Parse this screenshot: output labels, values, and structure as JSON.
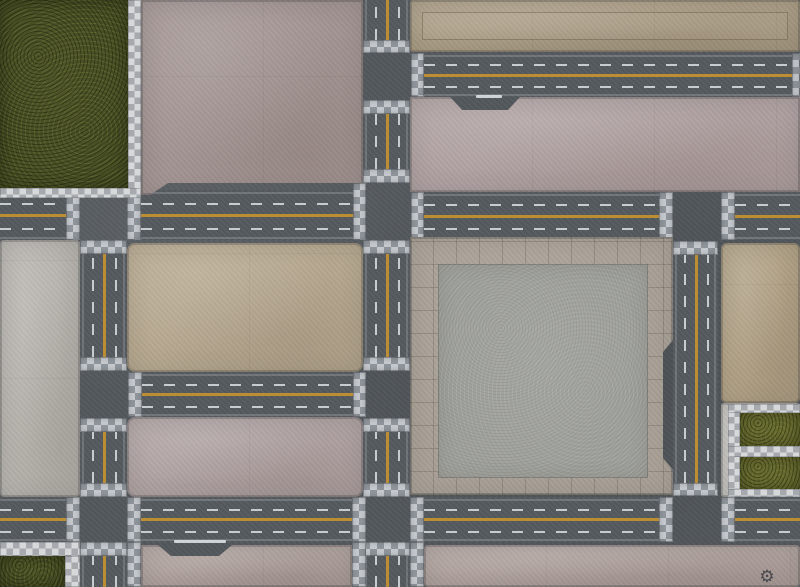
{
  "scene": {
    "description": "Top-down city-streets gaming mat: asphalt roads with yellow center lines and dashed lanes, checkered crosswalks, concrete city blocks, central tiled plaza, grass corner lots",
    "canvas": {
      "width": 800,
      "height": 587
    }
  },
  "palette": {
    "asphalt": "#53585d",
    "lane_yellow": "#bb8e33",
    "lane_white": "#d8dde1",
    "crosswalk_light": "#c5c9cd",
    "crosswalk_dark": "#8f959b",
    "sidewalk_light": "#d6d8da",
    "sidewalk_dark": "#a6aaae",
    "grass_dark": "#474d24",
    "grass_olive": "#696b2f",
    "concrete_mauve": "#a29492",
    "concrete_tan": "#ab9d85",
    "concrete_pink": "#b0a1a1",
    "concrete_gray": "#b7b4ae",
    "concrete_warm_tan": "#b7a88f",
    "plaza_tile": "#a8a096",
    "plaza_inner": "#9da09b",
    "bottom_pink": "#b0a29e",
    "frame_light": "#c4c2bd"
  },
  "icons": {
    "gear_logo": "⚙"
  },
  "regions": [
    {
      "name": "asphalt-base",
      "type": "base",
      "x": 0,
      "y": 0,
      "w": 800,
      "h": 587
    },
    {
      "name": "road-west-horizontal-seg-1",
      "type": "road-h",
      "x": 0,
      "y": 190,
      "w": 66,
      "h": 50
    },
    {
      "name": "road-west-horizontal-seg-2",
      "type": "road-h",
      "x": 141,
      "y": 190,
      "w": 212,
      "h": 50
    },
    {
      "name": "road-east-horizontal-seg-1",
      "type": "road-h",
      "x": 424,
      "y": 192,
      "w": 235,
      "h": 48
    },
    {
      "name": "road-east-horizontal-seg-2",
      "type": "road-h",
      "x": 735,
      "y": 192,
      "w": 65,
      "h": 48
    },
    {
      "name": "road-top-right-horizontal",
      "type": "road-h",
      "x": 424,
      "y": 53,
      "w": 368,
      "h": 44
    },
    {
      "name": "road-mid-horizontal",
      "type": "road-h",
      "x": 142,
      "y": 372,
      "w": 211,
      "h": 45
    },
    {
      "name": "road-bottom-horizontal-seg-1",
      "type": "road-h",
      "x": 0,
      "y": 497,
      "w": 66,
      "h": 45
    },
    {
      "name": "road-bottom-horizontal-seg-2",
      "type": "road-h",
      "x": 141,
      "y": 497,
      "w": 211,
      "h": 45
    },
    {
      "name": "road-bottom-horizontal-seg-3",
      "type": "road-h",
      "x": 424,
      "y": 497,
      "w": 235,
      "h": 45
    },
    {
      "name": "road-bottom-horizontal-seg-4",
      "type": "road-h",
      "x": 735,
      "y": 497,
      "w": 65,
      "h": 45
    },
    {
      "name": "road-left-vertical-seg-1",
      "type": "road-v",
      "x": 80,
      "y": 254,
      "w": 47,
      "h": 103
    },
    {
      "name": "road-left-vertical-seg-2",
      "type": "road-v",
      "x": 80,
      "y": 432,
      "w": 47,
      "h": 51
    },
    {
      "name": "road-left-vertical-seg-3",
      "type": "road-v",
      "x": 80,
      "y": 556,
      "w": 47,
      "h": 31
    },
    {
      "name": "road-center-vertical-seg-1",
      "type": "road-v",
      "x": 363,
      "y": 0,
      "w": 47,
      "h": 40
    },
    {
      "name": "road-center-vertical-seg-2",
      "type": "road-v",
      "x": 363,
      "y": 114,
      "w": 47,
      "h": 55
    },
    {
      "name": "road-center-vertical-seg-3",
      "type": "road-v",
      "x": 363,
      "y": 254,
      "w": 47,
      "h": 103
    },
    {
      "name": "road-center-vertical-seg-4",
      "type": "road-v",
      "x": 363,
      "y": 432,
      "w": 47,
      "h": 51
    },
    {
      "name": "road-center-vertical-seg-5",
      "type": "road-v",
      "x": 363,
      "y": 556,
      "w": 47,
      "h": 31
    },
    {
      "name": "road-right-vertical",
      "type": "road-v",
      "x": 673,
      "y": 255,
      "w": 45,
      "h": 228
    },
    {
      "name": "crosswalk",
      "type": "xwalk",
      "x": 66,
      "y": 183,
      "w": 14,
      "h": 57
    },
    {
      "name": "crosswalk",
      "type": "xwalk",
      "x": 127,
      "y": 183,
      "w": 14,
      "h": 57
    },
    {
      "name": "crosswalk",
      "type": "xwalk",
      "x": 353,
      "y": 183,
      "w": 13,
      "h": 57
    },
    {
      "name": "crosswalk",
      "type": "xwalk",
      "x": 411,
      "y": 192,
      "w": 13,
      "h": 48
    },
    {
      "name": "crosswalk",
      "type": "xwalk",
      "x": 659,
      "y": 192,
      "w": 14,
      "h": 48
    },
    {
      "name": "crosswalk",
      "type": "xwalk",
      "x": 721,
      "y": 192,
      "w": 14,
      "h": 48
    },
    {
      "name": "crosswalk",
      "type": "xwalk",
      "x": 411,
      "y": 53,
      "w": 13,
      "h": 44
    },
    {
      "name": "sidewalk-edge",
      "type": "xwalk",
      "x": 792,
      "y": 53,
      "w": 8,
      "h": 44
    },
    {
      "name": "crosswalk",
      "type": "xwalk",
      "x": 128,
      "y": 372,
      "w": 14,
      "h": 45
    },
    {
      "name": "crosswalk",
      "type": "xwalk",
      "x": 353,
      "y": 372,
      "w": 13,
      "h": 45
    },
    {
      "name": "crosswalk",
      "type": "xwalk",
      "x": 66,
      "y": 497,
      "w": 14,
      "h": 45
    },
    {
      "name": "crosswalk",
      "type": "xwalk",
      "x": 127,
      "y": 497,
      "w": 14,
      "h": 45
    },
    {
      "name": "crosswalk",
      "type": "xwalk",
      "x": 352,
      "y": 497,
      "w": 14,
      "h": 45
    },
    {
      "name": "crosswalk",
      "type": "xwalk",
      "x": 410,
      "y": 497,
      "w": 14,
      "h": 45
    },
    {
      "name": "crosswalk",
      "type": "xwalk",
      "x": 659,
      "y": 497,
      "w": 14,
      "h": 45
    },
    {
      "name": "crosswalk",
      "type": "xwalk",
      "x": 721,
      "y": 497,
      "w": 14,
      "h": 45
    },
    {
      "name": "crosswalk",
      "type": "xwalk",
      "x": 80,
      "y": 240,
      "w": 47,
      "h": 14
    },
    {
      "name": "crosswalk",
      "type": "xwalk",
      "x": 80,
      "y": 357,
      "w": 47,
      "h": 14
    },
    {
      "name": "crosswalk",
      "type": "xwalk",
      "x": 80,
      "y": 418,
      "w": 47,
      "h": 14
    },
    {
      "name": "crosswalk",
      "type": "xwalk",
      "x": 80,
      "y": 483,
      "w": 47,
      "h": 14
    },
    {
      "name": "crosswalk",
      "type": "xwalk",
      "x": 80,
      "y": 542,
      "w": 47,
      "h": 14
    },
    {
      "name": "crosswalk",
      "type": "xwalk",
      "x": 363,
      "y": 40,
      "w": 47,
      "h": 13
    },
    {
      "name": "crosswalk",
      "type": "xwalk",
      "x": 363,
      "y": 100,
      "w": 47,
      "h": 14
    },
    {
      "name": "crosswalk",
      "type": "xwalk",
      "x": 363,
      "y": 169,
      "w": 47,
      "h": 14
    },
    {
      "name": "crosswalk",
      "type": "xwalk",
      "x": 363,
      "y": 240,
      "w": 47,
      "h": 14
    },
    {
      "name": "crosswalk",
      "type": "xwalk",
      "x": 363,
      "y": 357,
      "w": 47,
      "h": 14
    },
    {
      "name": "crosswalk",
      "type": "xwalk",
      "x": 363,
      "y": 418,
      "w": 47,
      "h": 14
    },
    {
      "name": "crosswalk",
      "type": "xwalk",
      "x": 363,
      "y": 483,
      "w": 47,
      "h": 14
    },
    {
      "name": "crosswalk",
      "type": "xwalk",
      "x": 363,
      "y": 542,
      "w": 47,
      "h": 14
    },
    {
      "name": "crosswalk",
      "type": "xwalk",
      "x": 673,
      "y": 241,
      "w": 45,
      "h": 14
    },
    {
      "name": "crosswalk",
      "type": "xwalk",
      "x": 673,
      "y": 483,
      "w": 45,
      "h": 13
    },
    {
      "name": "sidewalk-strip",
      "type": "xwalk",
      "x": 127,
      "y": 542,
      "w": 14,
      "h": 45
    },
    {
      "name": "sidewalk-strip",
      "type": "xwalk",
      "x": 352,
      "y": 542,
      "w": 14,
      "h": 45
    },
    {
      "name": "sidewalk-strip",
      "type": "xwalk",
      "x": 410,
      "y": 542,
      "w": 14,
      "h": 45
    },
    {
      "name": "stop-bar",
      "type": "stopbar",
      "x": 476,
      "y": 95,
      "w": 26,
      "h": 3
    },
    {
      "name": "stop-bar",
      "type": "stopbar",
      "x": 174,
      "y": 540,
      "w": 52,
      "h": 3
    },
    {
      "name": "grass-lot-top-left",
      "type": "grass",
      "x": 0,
      "y": 0,
      "w": 128,
      "h": 188,
      "fill": "#474d24"
    },
    {
      "name": "sidewalk-border",
      "type": "checker",
      "x": 128,
      "y": 0,
      "w": 13,
      "h": 198
    },
    {
      "name": "sidewalk-border",
      "type": "checker",
      "x": 0,
      "y": 188,
      "w": 141,
      "h": 10
    },
    {
      "name": "city-block-top-middle",
      "type": "block",
      "x": 141,
      "y": 0,
      "w": 222,
      "h": 195,
      "fill": "#a29492",
      "clip": "0 0,100% 0,100% 183px,27px 183px,9px 195px,0 100%"
    },
    {
      "name": "city-block-top-right-roof",
      "type": "block roof",
      "x": 410,
      "y": 0,
      "w": 390,
      "h": 52,
      "fill": "#ab9d85",
      "r": 3
    },
    {
      "name": "city-block-right-upper",
      "type": "block",
      "x": 410,
      "y": 97,
      "w": 390,
      "h": 95,
      "fill": "#b0a1a1",
      "clip": "0 0,40px 0,52px 13px,98px 13px,110px 0,100% 0,100% 100%,0 100%"
    },
    {
      "name": "city-block-left-gray",
      "type": "block",
      "x": 0,
      "y": 240,
      "w": 80,
      "h": 257,
      "fill": "#b7b4ae",
      "r": 4
    },
    {
      "name": "city-block-middle-tan",
      "type": "block",
      "x": 127,
      "y": 243,
      "w": 236,
      "h": 129,
      "fill": "#b7a88f",
      "r": 8
    },
    {
      "name": "city-block-middle-pink",
      "type": "block",
      "x": 127,
      "y": 417,
      "w": 236,
      "h": 80,
      "fill": "#b0a2a2",
      "r": 8
    },
    {
      "name": "central-tiled-plaza",
      "type": "plaza",
      "x": 410,
      "y": 237,
      "w": 263,
      "h": 258,
      "clip": "0 0,100% 0,100% 103px,253px 115px,253px 221px,100% 233px,100% 100%,0 100%"
    },
    {
      "name": "city-block-right-middle",
      "type": "block",
      "x": 721,
      "y": 243,
      "w": 79,
      "h": 160,
      "fill": "#b2a286",
      "r": 6
    },
    {
      "name": "grass-frame-bottom-right",
      "type": "block",
      "x": 721,
      "y": 403,
      "w": 79,
      "h": 94,
      "fill": "#c4c2bd",
      "r": 3
    },
    {
      "name": "sidewalk-border",
      "type": "checker",
      "x": 728,
      "y": 404,
      "w": 12,
      "h": 92
    },
    {
      "name": "sidewalk-border",
      "type": "checker",
      "x": 728,
      "y": 404,
      "w": 72,
      "h": 9
    },
    {
      "name": "sidewalk-border",
      "type": "checker",
      "x": 728,
      "y": 446,
      "w": 72,
      "h": 11
    },
    {
      "name": "sidewalk-border",
      "type": "checker",
      "x": 728,
      "y": 489,
      "w": 72,
      "h": 8
    },
    {
      "name": "grass-lot-bottom-right-1",
      "type": "grass",
      "x": 740,
      "y": 413,
      "w": 60,
      "h": 33,
      "fill": "#696b2f"
    },
    {
      "name": "grass-lot-bottom-right-2",
      "type": "grass",
      "x": 740,
      "y": 457,
      "w": 60,
      "h": 32,
      "fill": "#696b2f"
    },
    {
      "name": "sidewalk-border",
      "type": "checker",
      "x": 0,
      "y": 542,
      "w": 80,
      "h": 14
    },
    {
      "name": "grass-lot-bottom-left",
      "type": "grass",
      "x": 0,
      "y": 556,
      "w": 65,
      "h": 31,
      "fill": "#474d24"
    },
    {
      "name": "sidewalk-border",
      "type": "checker",
      "x": 65,
      "y": 556,
      "w": 15,
      "h": 31
    },
    {
      "name": "city-block-bottom-left",
      "type": "block",
      "x": 141,
      "y": 545,
      "w": 211,
      "h": 42,
      "fill": "#b0a29e",
      "clip": "0 0,17px 0,30px 11px,78px 11px,91px 0,100% 0,100% 100%,0 100%"
    },
    {
      "name": "city-block-bottom-right",
      "type": "block",
      "x": 424,
      "y": 545,
      "w": 376,
      "h": 42,
      "fill": "#b0a29e",
      "r": 4
    },
    {
      "name": "gear-logo-icon",
      "type": "gear",
      "x": 756,
      "y": 566,
      "w": 22,
      "h": 22,
      "glyph": "⚙"
    }
  ]
}
